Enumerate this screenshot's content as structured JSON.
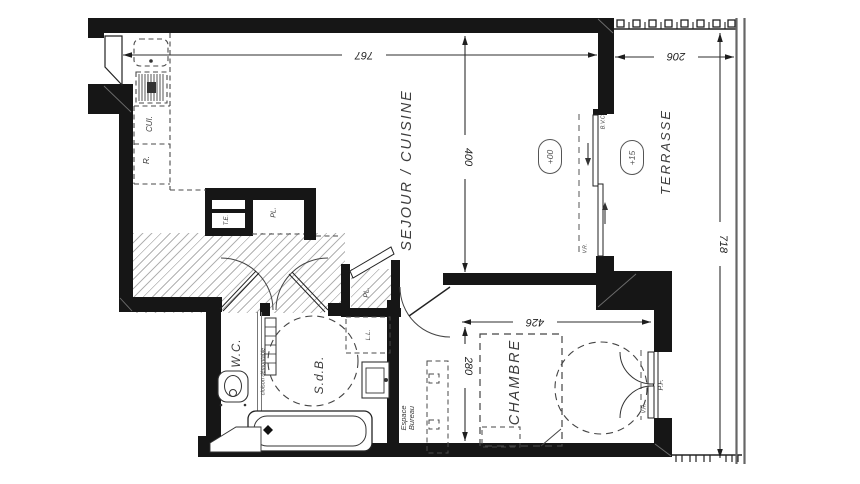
{
  "drawing": {
    "rooms": {
      "sejour_cuisine": "SEJOUR / CUISINE",
      "terrasse": "TERRASSE",
      "chambre": "CHAMBRE",
      "sdb": "S.d.B.",
      "wc": "W.C.",
      "bureau_line1": "Espace",
      "bureau_line2": "Bureau"
    },
    "fixtures": {
      "cuisine_abbr": "CUI.",
      "fridge_abbr": "R.",
      "elec_panel_abbr": "T.E.",
      "closet_entry_abbr": "PL.",
      "closet_hall_abbr": "PL.",
      "washer_abbr": "L.L.",
      "bay_window_abbr": "B.V.C.",
      "shutter_sejour_abbr": "V.R.",
      "shutter_chambre_abbr": "V.R.",
      "french_window_abbr": "P.F.",
      "partition_note": "cloison démontable"
    },
    "levels": {
      "sejour_level": "+00",
      "terrasse_level": "+15"
    },
    "dimensions": {
      "sejour_width": "767",
      "sejour_depth": "400",
      "terrasse_width": "206",
      "chambre_width": "426",
      "chambre_depth": "280",
      "facade_height": "718"
    },
    "colors": {
      "wall": "#161616",
      "line": "#2e2e2e",
      "hatch": "#b2b2b2",
      "text": "#3a3a3a"
    }
  }
}
